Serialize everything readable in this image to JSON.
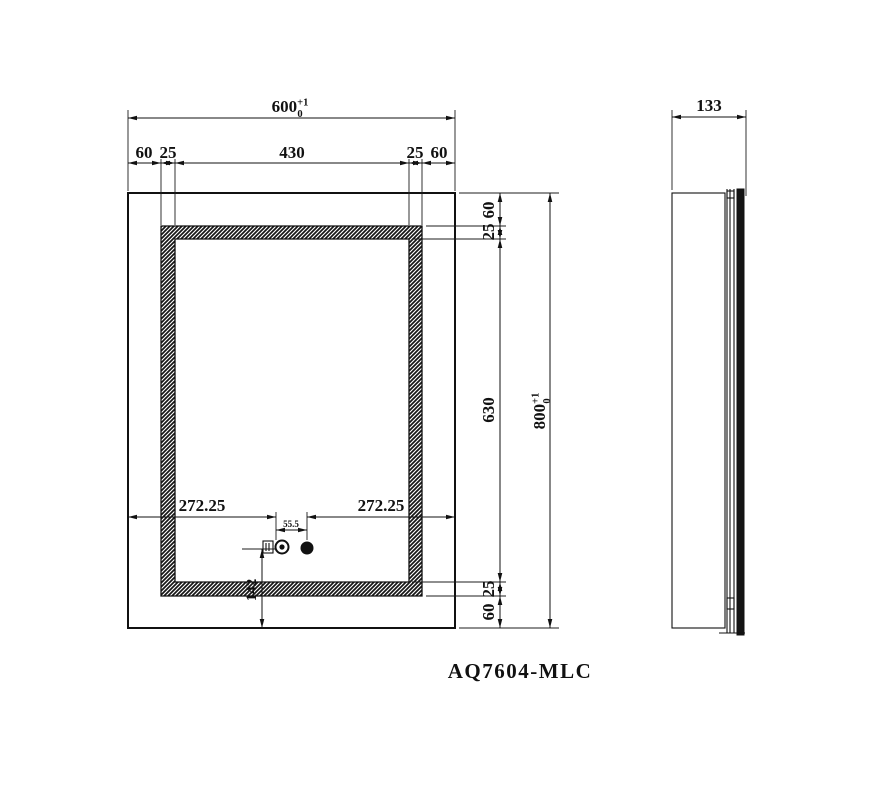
{
  "title": "AQ7604-MLC",
  "front_view": {
    "width_total": {
      "value": "600",
      "tol_plus": "+1",
      "tol_minus": "0"
    },
    "width_chain": [
      "60",
      "25",
      "430",
      "25",
      "60"
    ],
    "height_total": {
      "value": "800",
      "tol_plus": "+1",
      "tol_minus": "0"
    },
    "height_chain": [
      "60",
      "25",
      "630",
      "25",
      "60"
    ],
    "sensor_offset_left": "272.25",
    "sensor_offset_right": "272.25",
    "sensor_gap": "55.5",
    "sensor_bottom_offset": "142"
  },
  "side_view": {
    "depth": "133"
  },
  "colors": {
    "line": "#111111",
    "background": "#ffffff"
  }
}
